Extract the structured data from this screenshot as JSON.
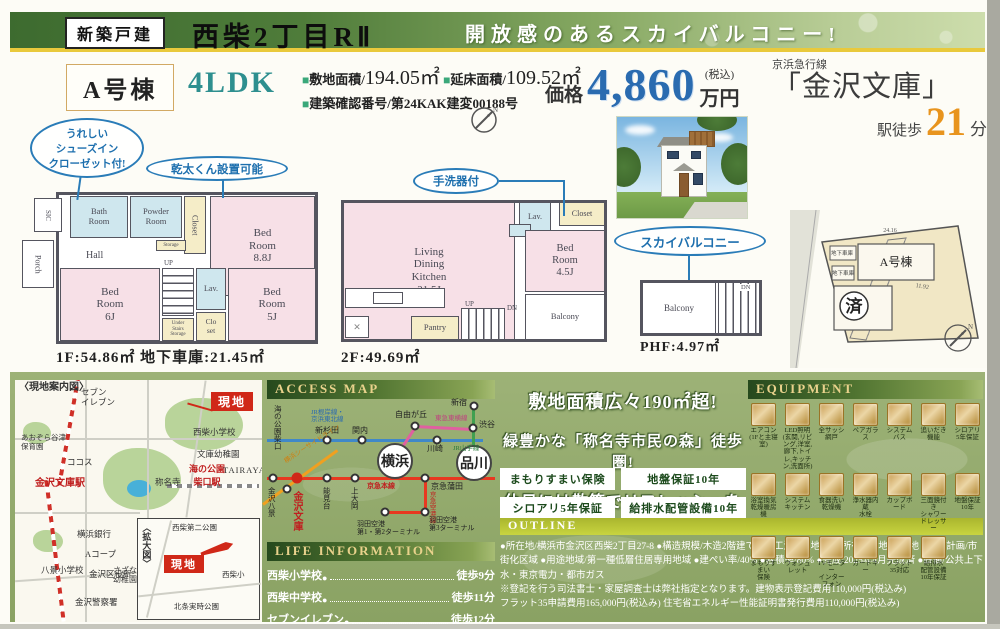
{
  "header": {
    "badge": "新築戸建",
    "title": "西柴2丁目RⅡ",
    "slogan": "開放感のあるスカイバルコニー!"
  },
  "property": {
    "unit": "A号棟",
    "layout": "4LDK",
    "bullet": "■",
    "spec1_label": "敷地面積/",
    "spec1_value": "194.05㎡",
    "spec2_label": "延床面積/",
    "spec2_value": "109.52㎡",
    "spec3": "建築確認番号/第24KAK建変00188号",
    "price_label": "価格",
    "price_amount": "4,860",
    "price_tax": "(税込)",
    "price_unit": "万円",
    "station_line": "京浜急行線",
    "station_name": "「金沢文庫」",
    "walk_label": "駅徒歩",
    "walk_min": "21",
    "walk_unit": "分"
  },
  "floor1": {
    "callout1": "うれしい\nシューズイン\nクローゼット付!",
    "callout2": "乾太くん設置可能",
    "rooms": {
      "sic": "SIC",
      "porch": "Porch",
      "bath": "Bath\nRoom",
      "powder": "Powder\nRoom",
      "storage": "Storage",
      "closet": "Closet",
      "bed88": "Bed\nRoom\n8.8J",
      "hall": "Hall",
      "up": "UP",
      "lav": "Lav.",
      "under": "Under\nStairs\nStorage",
      "clo": "Clo\nset",
      "bed6": "Bed\nRoom\n6J",
      "bed5": "Bed\nRoom\n5J"
    },
    "caption": "1F:54.86㎡ 地下車庫:21.45㎡"
  },
  "floor2": {
    "callout": "手洗器付",
    "rooms": {
      "ldk": "Living\nDining\nKitchen\n21.5J",
      "lav": "Lav.",
      "closet": "Closet",
      "bed45": "Bed\nRoom\n4.5J",
      "balcony": "Balcony",
      "pantry": "Pantry",
      "up": "UP",
      "dn": "DN"
    },
    "caption": "2F:49.69㎡"
  },
  "phf": {
    "callout": "スカイバルコニー",
    "rooms": {
      "balcony": "Balcony",
      "dn": "DN"
    },
    "caption": "PHF:4.97㎡"
  },
  "siteplan": {
    "building": "A号棟",
    "sold": "済",
    "garage1": "地下車庫",
    "garage2": "地下車庫",
    "dim1": "24.16",
    "dim2": "11.92",
    "north": "N"
  },
  "map": {
    "title": "〈現地案内図〉",
    "inset_title": "〈拡大図〉",
    "flag1": "現地",
    "flag2": "現地",
    "station1": "金沢文庫駅",
    "station2": "海の公園\n柴口駅",
    "labels": [
      "セブン\nイレブン",
      "西柴小学校",
      "文庫幼稚園",
      "TAIRAYA",
      "称名寺",
      "ココス",
      "あおぞら谷津\n保育園",
      "横浜銀行",
      "Aコープ",
      "金沢区役所",
      "八景小学校",
      "金沢警察署",
      "さざなみ\n幼稚園",
      "西柴第二公園",
      "西柴小",
      "北条実時公園"
    ]
  },
  "access": {
    "title": "ACCESS MAP",
    "line_names": {
      "jr": "JR根岸線・\n京浜東北線",
      "keikyu": "京急本線",
      "seaside": "横浜シーサイドライン",
      "toyoko": "東急東横線",
      "yamanote": "JR山手線",
      "airport": "京急空港線"
    },
    "stations": {
      "umi_koen": "海の公園柴口",
      "shin_sugita": "新杉田",
      "kannai": "関内",
      "kawasaki": "川崎",
      "jiyugaoka": "自由が丘",
      "shinjuku": "新宿",
      "shibuya": "渋谷",
      "kanazawa_hakkei": "金沢八景",
      "kanazawa_bunko": "金沢文庫",
      "nokendai": "能見台",
      "kamiooka": "上大岡",
      "yokohama": "横浜",
      "keikyu_kamata": "京急蒲田",
      "shinagawa": "品川",
      "haneda3": "羽田空港\n第3ターミナル",
      "haneda12": "羽田空港\n第1・第2ターミナル"
    }
  },
  "highlights": {
    "line1": "敷地面積広々190㎡超!",
    "line2": "緑豊かな「称名寺市民の森」徒歩圏!",
    "line3": "休日には散策でリフレッシュを",
    "badges": [
      "まもりすまい保険",
      "地盤保証10年",
      "シロアリ5年保証",
      "給排水配管設備10年保証"
    ]
  },
  "equipment": {
    "title": "EQUIPMENT",
    "items": [
      "エアコン\n(1Fと主寝室)",
      "LED照明\n(玄関,リビング,洋室,廊下,トイレ,キッチン,洗面所)",
      "全サッシ網戸",
      "ペアガラス",
      "システムバス",
      "追いだき機能",
      "シロアリ\n5年保証",
      "浴室換気\n乾燥暖房機",
      "システム\nキッチン",
      "食器洗い\n乾燥機",
      "浄水器内蔵\n水栓",
      "カップボード",
      "三面鏡付き\nシャワードレッサー",
      "地盤保証\n10年",
      "まもりすまい\n保険",
      "ウォシュレット",
      "TVモニター\nインターフォン",
      "カードキー",
      "フラット35対応",
      "給排水\n配管設備\n10年保証"
    ]
  },
  "life": {
    "title": "LIFE INFORMATION",
    "items": [
      {
        "name": "西柴小学校",
        "time": "徒歩9分"
      },
      {
        "name": "西柴中学校",
        "time": "徒歩11分"
      },
      {
        "name": "セブンイレブン",
        "time": "徒歩12分"
      }
    ]
  },
  "outline": {
    "title": "OUTLINE",
    "line1": "●所在地/横浜市金沢区西柴2丁目27-8 ●構造規模/木造2階建て在来工法 ●土地権利/所有権 ●地目/宅地 ●都市計画/市街化区域 ●用途地域/第一種低層住居専用地域 ●建ぺい率/40% ●容積率/80% ●完成/2025年4月完成済 ●設備/公共上下水・東京電力・都市ガス",
    "line2": "※登記を行う司法書士・家屋調査士は弊社指定となります。建物表示登記費用110,000円(税込み)",
    "line3": "フラット35申請費用165,000円(税込み) 住宅省エネルギー性能証明書発行費用110,000円(税込み)"
  }
}
